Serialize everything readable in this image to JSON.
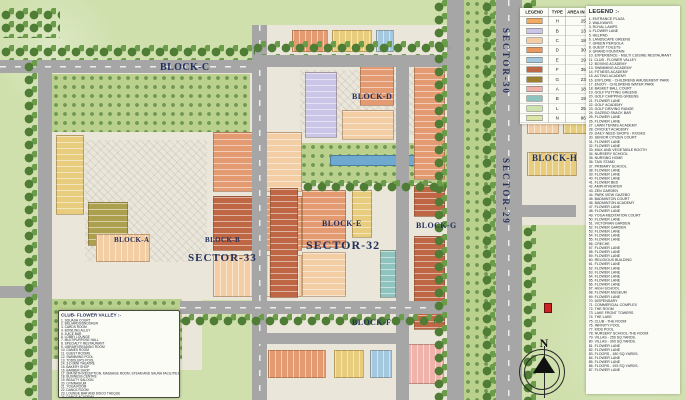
{
  "map": {
    "palette": {
      "outside": "#cfe0ad",
      "land": "#eae6d9",
      "road": "#a6a6a6",
      "tree": "#4f7d36",
      "parkgreen": "#b9d18d",
      "pool": "#6fa9cf",
      "label": "#23305c",
      "salmon": "#e59b72",
      "peach": "#f3cda4",
      "yellow": "#e7cd7d",
      "blue": "#a5c8e1",
      "terracotta": "#bf6744",
      "olive": "#aca04f",
      "lavender": "#cbc5e8",
      "teal": "#8fc3bd",
      "pink": "#efb3ab"
    },
    "labels": {
      "block_a": "BLOCK-A",
      "block_b": "BLOCK-B",
      "block_c": "BLOCK-C",
      "block_d": "BLOCK-D",
      "block_e": "BLOCK-E",
      "block_f": "BLOCK-F",
      "block_g": "BLOCK-G",
      "block_h": "BLOCK-H",
      "sector_29": "SECTOR-29",
      "sector_30": "SECTOR-30",
      "sector_32": "SECTOR-32",
      "sector_33": "SECTOR-33"
    },
    "compass_n": "N"
  },
  "legend_table": {
    "headers": [
      "LEGEND",
      "TYPE",
      "AREA IN SQ.YDS"
    ],
    "rows": [
      {
        "color": "#f2a962",
        "type": "H",
        "area": "250"
      },
      {
        "color": "#cbc5e8",
        "type": "B",
        "area": "134"
      },
      {
        "color": "#f3cda4",
        "type": "C",
        "area": "180"
      },
      {
        "color": "#e8995f",
        "type": "D",
        "area": "300"
      },
      {
        "color": "#a5c8e1",
        "type": "E",
        "area": "193"
      },
      {
        "color": "#bf6744",
        "type": "F",
        "area": "350"
      },
      {
        "color": "#9e7f2f",
        "type": "G",
        "area": "234"
      },
      {
        "color": "#efb3ab",
        "type": "A",
        "area": "180"
      },
      {
        "color": "#8fc3bd",
        "type": "B",
        "area": "193"
      },
      {
        "color": "#cfe3ad",
        "type": "L",
        "area": "250"
      },
      {
        "color": "#dce6a8",
        "type": "N",
        "area": "866"
      }
    ]
  },
  "legend": {
    "title": "LEGEND :-",
    "items": [
      "ENTRANCE PLAZA",
      "WALKWAYS",
      "ROYAL LAMPS",
      "FLOWER LANE",
      "HELIPAD",
      "LANDSCAPE GREENS",
      "GREEN PERGOLA",
      "GUEST TOILETS",
      "GRAND FOUNTAIN",
      "EXPERIENCE - MULTI CUISINE RESTAURANT",
      "CLUB - FLOWER VALLEY",
      "BOXING ACADEMY",
      "SWIMMING ACADEMY",
      "FITNESS ACADEMY",
      "ACTING ACADEMY",
      "EXPLORE - CHILDRENS AMUSEMENT PARK",
      "ENJOY - CHILDRENS WATER PARK",
      "BASKET BALL COURT",
      "GOLF PUTTING GREENS",
      "GOLF CHIPPING GREENS",
      "FLOWER LANE",
      "GOLF ACADEMY",
      "GOLF DRIVING RANGE",
      "GAZEBO SNACK BAR",
      "FLOWER LANE",
      "FLOWER LANE",
      "LAWN TENNIS ACADEMY",
      "CRICKET ACADEMY",
      "DAILY NEED SHOPS - KIOSKS",
      "SENIOR CITIZEN COURT",
      "FLOWER LANE",
      "FLOWER LANE",
      "MILK AND VEGETABLE BOOTH",
      "NURSERY SCHOOL",
      "NURSING HOME",
      "TAXI STAND",
      "PRIMARY SCHOOL",
      "FLOWER LANE",
      "FLOWER LANE",
      "FLOWER LANE",
      "FLOWER BED",
      "AMPHITHEATER",
      "ZEN GARDEN",
      "PARK VIEW GAZEBO",
      "BADMINTON COURT",
      "BADMINTON ACADEMY",
      "FLOWER LANE",
      "FLOWER LANE",
      "YOGA MEDITATION COURT",
      "FLOWER LANE",
      "VICTORIAN GARDEN",
      "FLOWER GARDEN",
      "FLOWER LANE",
      "FLOWER LANE",
      "FLOWER LANE",
      "CRECHE",
      "FLOWER LANE",
      "FLOWER LANE",
      "FLOWER LANE",
      "RELIGIOUS BUILDING",
      "FLOWER LANE",
      "FLOWER LANE",
      "FLOWER LANE",
      "FLOWER LANE",
      "FLOWER LANE",
      "FLOWER LANE",
      "HIGH SCHOOL",
      "FLOWER MUSEUM",
      "FLOWER LANE",
      "DISPENSARY",
      "COMMERCIAL COMPLEX",
      "THE ROOM",
      "LAKE FRONT TOWERS",
      "THE LAKE",
      "CLUB - THE ROOM",
      "INFINITY POOL",
      "KIDS POOL",
      "NURSERY SCHOOL-THE ROOM",
      "VILLAS - 250 SQ.YARDS.",
      "VILLAS - 300 SQ.YARDS.",
      "FLOWER LANE",
      "FLOWER LANE",
      "FLOORS - 180 SQ.YARDS.",
      "FLOWER LANE",
      "FLOWER LANE",
      "FLOORS - 193 SQ.YARDS.",
      "FLOWER LANE"
    ]
  },
  "club": {
    "title": "CLUB- FLOWER VALLEY :-",
    "items": [
      "SQUASH COURT",
      "BILLIARDS/SNOOKER",
      "CARDS ROOM",
      "BOWLING ALLEY",
      "JUICE BAR",
      "LOBBY LOUNGE",
      "MULTIPURPOSE HALL",
      "SPECIALTY RESTAURANT",
      "LIBRARY/READING ROOM",
      "GAMES ROOM",
      "GUEST ROOMS",
      "SWIMMING POOL",
      "TODDLER'S POOL",
      "3-D MINI THEATRE",
      "BAKERY SHOP",
      "BARBER SHOP",
      "SPA WITH RECEPTION, MASSAGE ROOM, STEAM AND SAUNA FACILITIES",
      "BUSINESS CENTRE",
      "BEAUTY SALOON",
      "GYMNASIUM",
      "YOGA ROOM",
      "DANCE ROOM",
      "LOUNGE BAR AND DISCO THEQUE",
      "DANCE ACADEMY"
    ]
  }
}
